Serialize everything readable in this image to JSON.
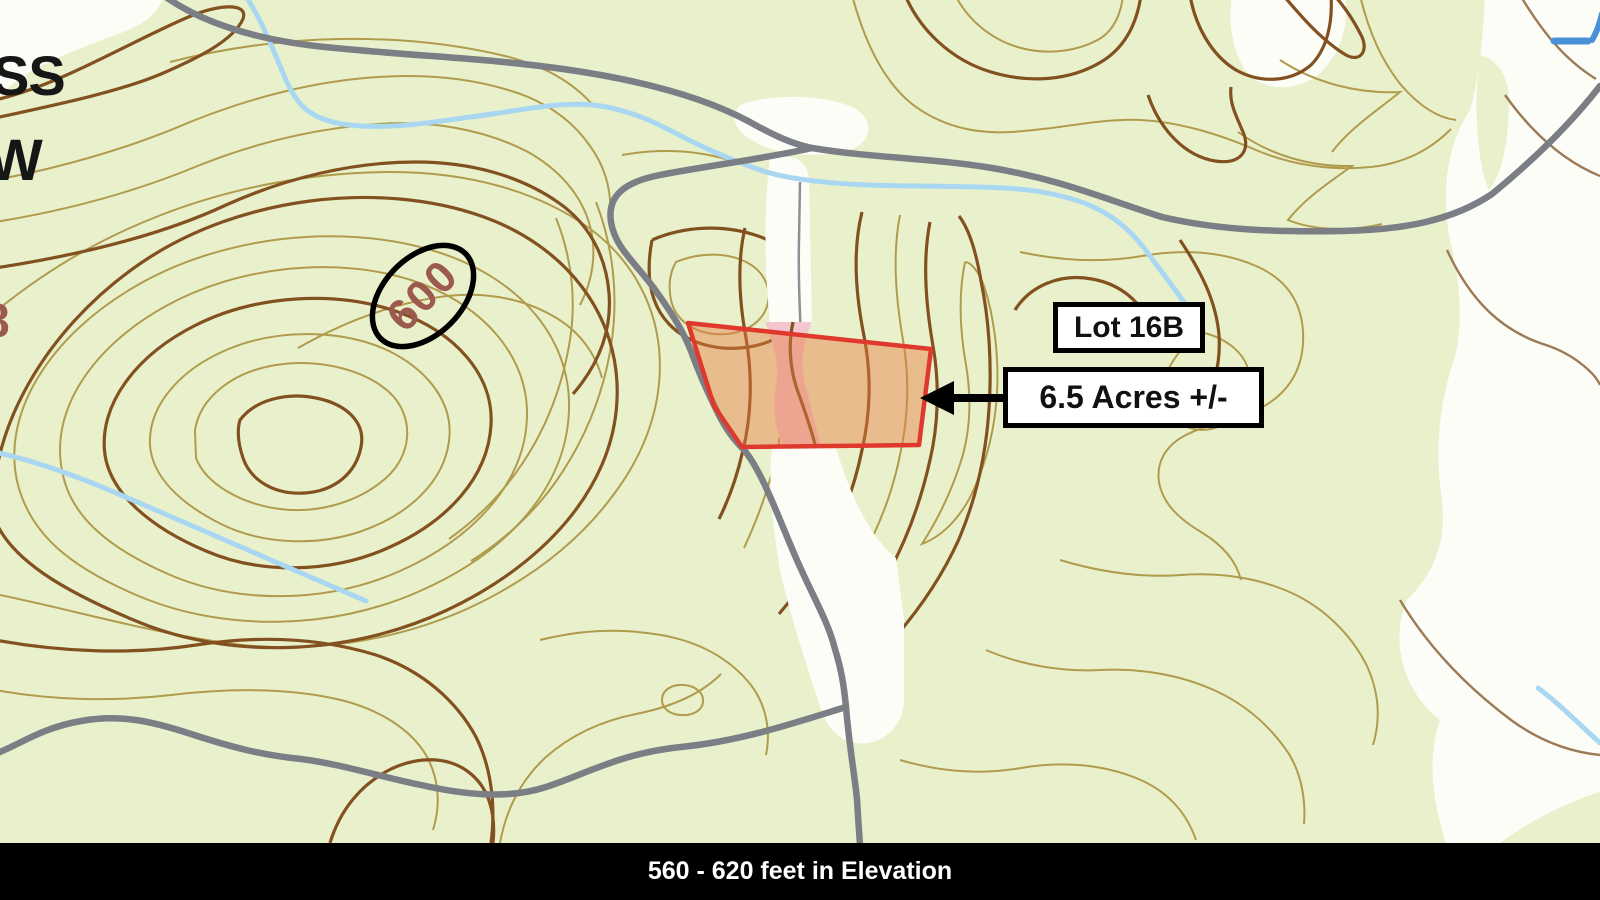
{
  "annotations": {
    "lot_label": "Lot 16B",
    "acreage_label": "6.5 Acres +/-",
    "contour_elevation_label": "600",
    "edge_label_line1": "SS",
    "edge_label_line2": "W",
    "edge_partial_digit": "8"
  },
  "footer": {
    "elevation_text": "560 - 620 feet in Elevation"
  },
  "colors": {
    "map_background": "#e9f1cc",
    "clearing_white": "#fdfdf8",
    "contour_light": "#b09b4d",
    "contour_index_dark": "#82511f",
    "contour_label_brown": "#9c5a4e",
    "road_gray": "#7b7e84",
    "stream_blue": "#a9d7f1",
    "parcel_outline_red": "#df392e",
    "parcel_fill_orange": "rgba(230,124,64,0.45)",
    "clearing_pink": "#f4c6cf",
    "highlight_ellipse_black": "#000000",
    "callout_background": "#ffffff",
    "callout_border": "#000000",
    "footer_background": "#000000",
    "footer_text": "#ffffff"
  }
}
